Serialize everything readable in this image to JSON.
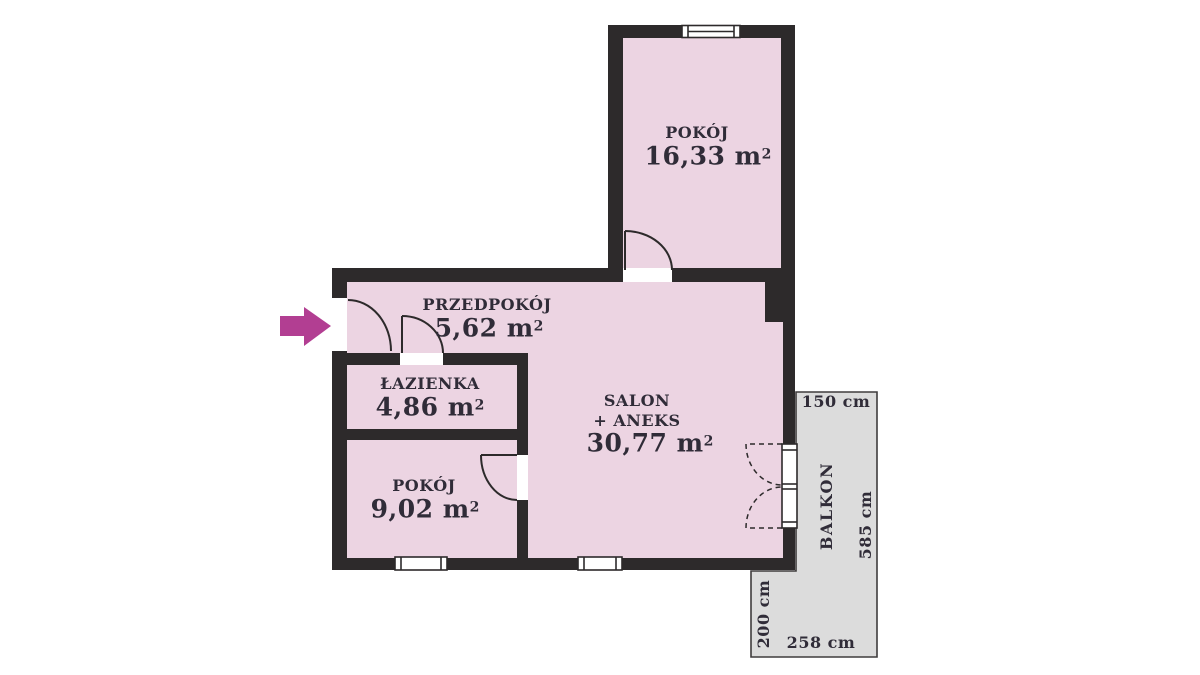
{
  "plan": {
    "rooms": [
      {
        "name": "POKÓJ",
        "area": "16,33 m",
        "sup": "2"
      },
      {
        "name": "PRZEDPOKÓJ",
        "area": "5,62 m",
        "sup": "2"
      },
      {
        "name": "ŁAZIENKA",
        "area": "4,86 m",
        "sup": "2"
      },
      {
        "name": "POKÓJ",
        "area": "9,02 m",
        "sup": "2"
      },
      {
        "name": "SALON",
        "name2": "+ ANEKS",
        "area": "30,77 m",
        "sup": "2"
      }
    ],
    "balcony": {
      "label": "BALKON",
      "dim_top": "150 cm",
      "dim_right": "585 cm",
      "dim_left": "200 cm",
      "dim_bottom": "258 cm"
    },
    "colors": {
      "room_fill": "#ecd4e2",
      "wall": "#2d2a2b",
      "balcony_fill": "#dcdcdc",
      "balcony_stroke": "#3f3c3d",
      "entrance_arrow": "#b23e92",
      "text": "#302c38"
    }
  }
}
